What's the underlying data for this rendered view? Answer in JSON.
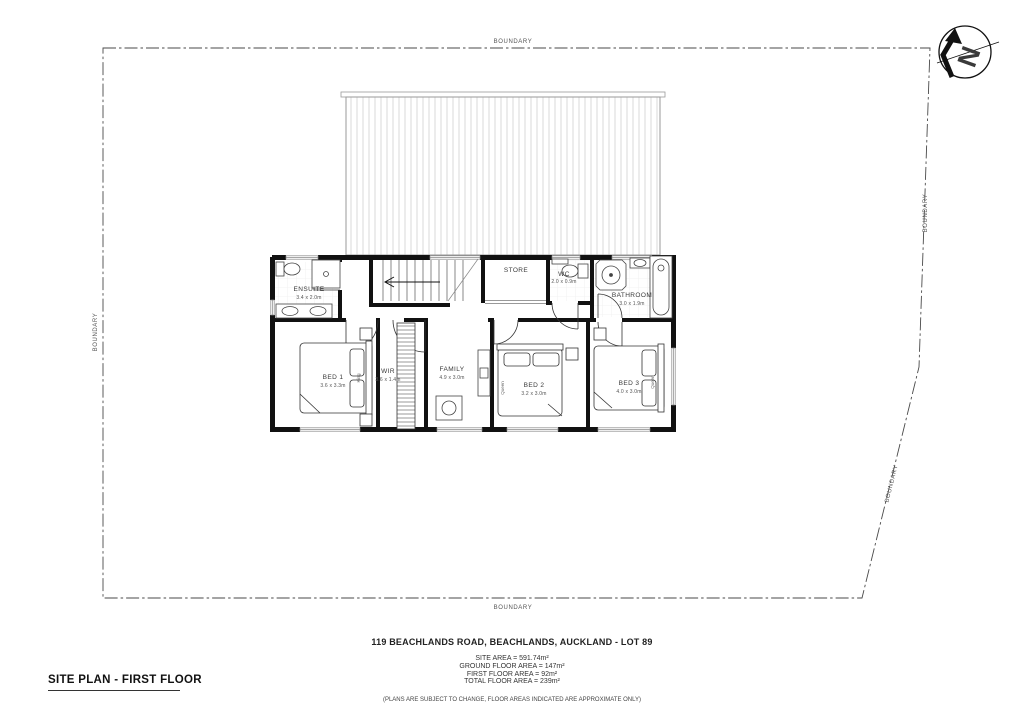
{
  "title_block": {
    "title": "SITE PLAN - FIRST FLOOR",
    "address": "119 BEACHLANDS ROAD, BEACHLANDS, AUCKLAND - LOT 89",
    "areas": [
      "SITE AREA = 591.74m²",
      "GROUND FLOOR AREA = 147m²",
      "FIRST FLOOR AREA = 92m²",
      "TOTAL FLOOR AREA = 239m²"
    ],
    "disclaimer": "(PLANS ARE SUBJECT TO CHANGE, FLOOR AREAS INDICATED ARE APPROXIMATE ONLY)"
  },
  "boundary_labels": {
    "top": "BOUNDARY",
    "left": "BOUNDARY",
    "right_upper": "BOUNDARY",
    "right_lower": "BOUNDARY",
    "bottom": "BOUNDARY"
  },
  "north_arrow": {
    "label": "N"
  },
  "rooms": [
    {
      "name": "ENSUITE",
      "dims": "3.4 x 2.0m"
    },
    {
      "name": "STORE",
      "dims": ""
    },
    {
      "name": "WC",
      "dims": "2.0 x 0.9m"
    },
    {
      "name": "BATHROOM",
      "dims": "3.0 x 1.9m"
    },
    {
      "name": "BED 1",
      "dims": "3.6 x 3.3m"
    },
    {
      "name": "WIR",
      "dims": "3.6 x 1.4m"
    },
    {
      "name": "FAMILY",
      "dims": "4.9 x 3.0m"
    },
    {
      "name": "BED 2",
      "dims": "3.2 x 3.0m"
    },
    {
      "name": "BED 3",
      "dims": "4.0 x 3.0m"
    }
  ],
  "bed_labels": {
    "bed1": "King",
    "bed2": "Queen",
    "bed3": "Queen"
  },
  "colors": {
    "ink": "#1a1a1a",
    "line": "#555555",
    "roof_hatch": "#d9d9d9"
  }
}
